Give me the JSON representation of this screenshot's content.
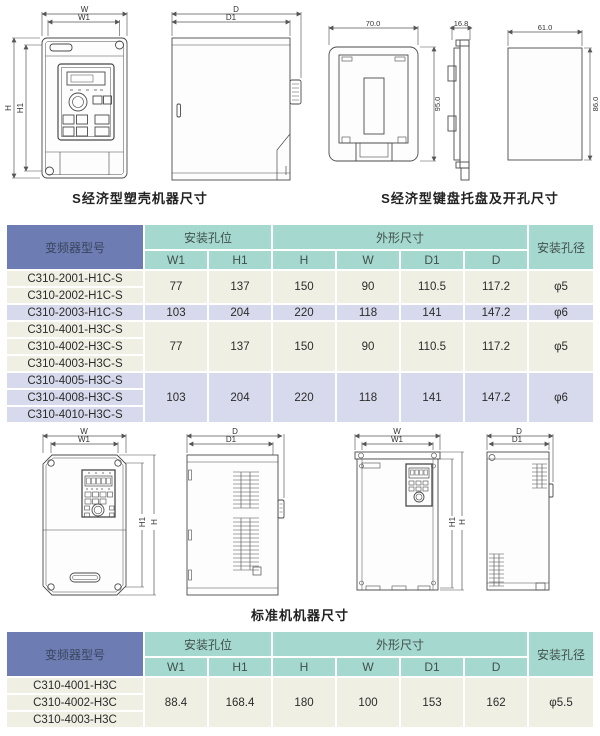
{
  "captions": {
    "economic_machine": "S经济型塑壳机器尺寸",
    "economic_keypad": "S经济型键盘托盘及开孔尺寸",
    "standard_machine": "标准机机器尺寸"
  },
  "dims": {
    "w": "W",
    "w1": "W1",
    "h": "H",
    "h1": "H1",
    "d": "D",
    "d1": "D1",
    "tray_width": "70.0",
    "tray_height": "95.0",
    "tray_depth": "16.8",
    "cutout_width": "61.0",
    "cutout_height": "86.0"
  },
  "colors": {
    "header_blue": "#6d7db3",
    "header_teal": "#a5d8cf",
    "row_cream": "#f0efe4",
    "row_lavender": "#d7daec"
  },
  "table1": {
    "header": {
      "model": "变频器型号",
      "mounting_holes": "安装孔位",
      "outline_dims": "外形尺寸",
      "hole_diameter": "安装孔径",
      "cols": [
        "W1",
        "H1",
        "H",
        "W",
        "D1",
        "D"
      ]
    },
    "groups": [
      {
        "models": [
          "C310-2001-H1C-S",
          "C310-2002-H1C-S"
        ],
        "values": [
          "77",
          "137",
          "150",
          "90",
          "110.5",
          "117.2",
          "φ5"
        ]
      },
      {
        "models": [
          "C310-2003-H1C-S"
        ],
        "values": [
          "103",
          "204",
          "220",
          "118",
          "141",
          "147.2",
          "φ6"
        ]
      },
      {
        "models": [
          "C310-4001-H3C-S",
          "C310-4002-H3C-S",
          "C310-4003-H3C-S"
        ],
        "values": [
          "77",
          "137",
          "150",
          "90",
          "110.5",
          "117.2",
          "φ5"
        ]
      },
      {
        "models": [
          "C310-4005-H3C-S",
          "C310-4008-H3C-S",
          "C310-4010-H3C-S"
        ],
        "values": [
          "103",
          "204",
          "220",
          "118",
          "141",
          "147.2",
          "φ6"
        ]
      }
    ]
  },
  "table2": {
    "header": {
      "model": "变频器型号",
      "mounting_holes": "安装孔位",
      "outline_dims": "外形尺寸",
      "hole_diameter": "安装孔径",
      "cols": [
        "W1",
        "H1",
        "H",
        "W",
        "D1",
        "D"
      ]
    },
    "groups": [
      {
        "models": [
          "C310-4001-H3C",
          "C310-4002-H3C",
          "C310-4003-H3C"
        ],
        "values": [
          "88.4",
          "168.4",
          "180",
          "100",
          "153",
          "162",
          "φ5.5"
        ]
      }
    ]
  }
}
